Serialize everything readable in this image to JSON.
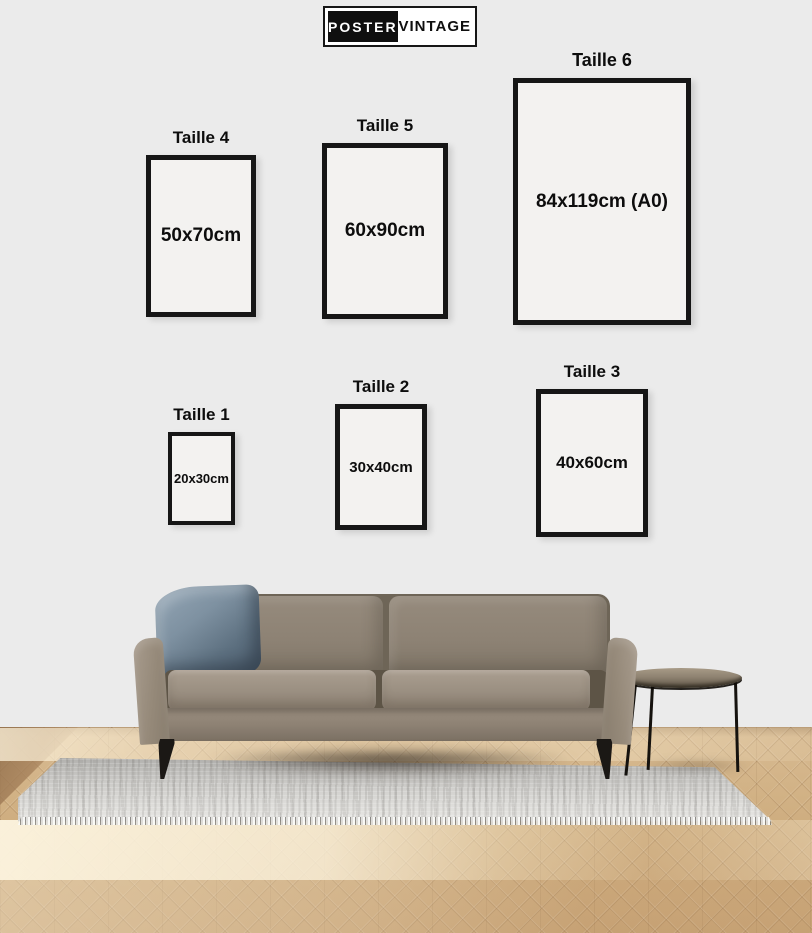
{
  "brand": {
    "name_primary": "POSTER",
    "name_secondary": "VINTAGE"
  },
  "size_guide": {
    "title": "Poster size guide",
    "sizes": [
      {
        "label": "Taille 1",
        "dimensions": "20x30cm"
      },
      {
        "label": "Taille 2",
        "dimensions": "30x40cm"
      },
      {
        "label": "Taille 3",
        "dimensions": "40x60cm"
      },
      {
        "label": "Taille 4",
        "dimensions": "50x70cm"
      },
      {
        "label": "Taille 5",
        "dimensions": "60x90cm"
      },
      {
        "label": "Taille 6",
        "dimensions": "84x119cm (A0)"
      }
    ]
  },
  "colors": {
    "wall": "#ebebeb",
    "frame_border": "#161616",
    "frame_fill": "#f3f2f0",
    "text": "#111111",
    "logo_black": "#0f0f0f",
    "logo_white": "#ffffff",
    "sofa": "#8f8476",
    "pillow": "#6f8192",
    "floor_wood": "#d0b084",
    "rug": "#d8d7d4"
  }
}
